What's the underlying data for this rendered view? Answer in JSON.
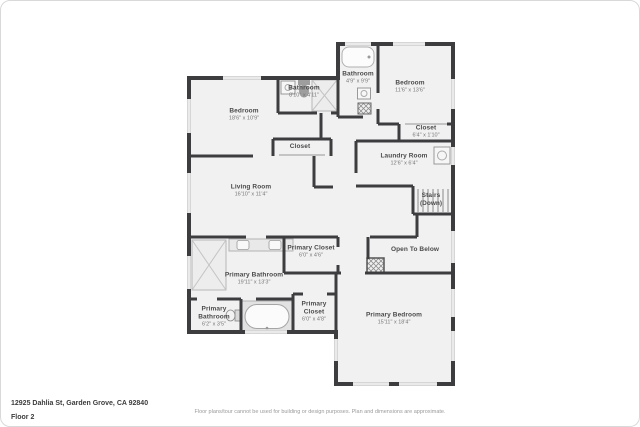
{
  "rooms": [
    {
      "id": "bathroom-top",
      "name": "Bathroom",
      "dims": "4'9\" x 9'9\""
    },
    {
      "id": "bedroom-right",
      "name": "Bedroom",
      "dims": "11'6\" x 13'6\""
    },
    {
      "id": "bathroom-middle",
      "name": "Bathroom",
      "dims": "8'10\" x 4'11\""
    },
    {
      "id": "bedroom-left",
      "name": "Bedroom",
      "dims": "18'6\" x 10'9\""
    },
    {
      "id": "closet-right",
      "name": "Closet",
      "dims": "6'4\" x 1'10\""
    },
    {
      "id": "closet-middle",
      "name": "Closet",
      "dims": ""
    },
    {
      "id": "laundry-room",
      "name": "Laundry Room",
      "dims": "12'6\" x 6'4\""
    },
    {
      "id": "living-room",
      "name": "Living Room",
      "dims": "16'10\" x 11'4\""
    },
    {
      "id": "stairs",
      "name": "Stairs",
      "dims": "(Down)"
    },
    {
      "id": "primary-closet-upper",
      "name": "Primary Closet",
      "dims": "6'0\" x 4'6\""
    },
    {
      "id": "open-to-below",
      "name": "Open To Below",
      "dims": ""
    },
    {
      "id": "primary-bathroom",
      "name": "Primary Bathroom",
      "dims": "19'11\" x 13'3\""
    },
    {
      "id": "primary-bathroom-small",
      "name": "Primary Bathroom",
      "dims": "6'2\" x 3'5\""
    },
    {
      "id": "primary-closet-lower",
      "name": "Primary Closet",
      "dims": "6'0\" x 4'8\""
    },
    {
      "id": "primary-bedroom",
      "name": "Primary Bedroom",
      "dims": "15'11\" x 18'4\""
    }
  ],
  "footer": {
    "address": "12925 Dahlia St, Garden Grove, CA 92840",
    "floor": "Floor 2",
    "disclaimer": "Floor plans/tour cannot be used for building or design purposes. Plan and dimensions are approximate."
  },
  "fixtures": [
    "bathtub-icon",
    "sink-icon",
    "toilet-icon",
    "shower-icon",
    "washer-icon",
    "stairs-treads-icon",
    "double-vanity-icon",
    "soaking-tub-icon",
    "chimney-hatch-icon"
  ],
  "colors": {
    "wall": "#3d3d40",
    "room_fill": "#f1f1f2",
    "window": "#d6d6d6",
    "label_name": "#4a4a4a",
    "label_dims": "#777777"
  }
}
